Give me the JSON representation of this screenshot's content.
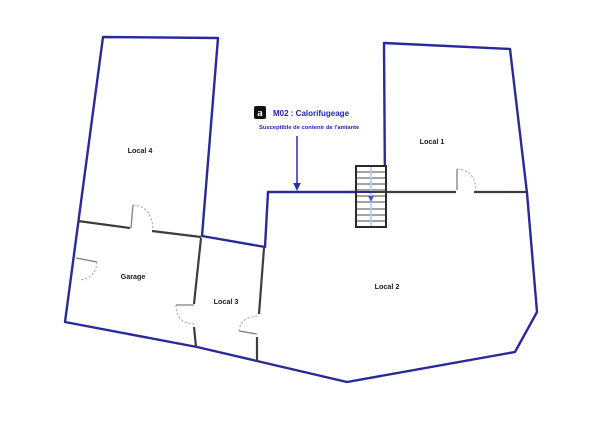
{
  "plan": {
    "rooms": [
      {
        "id": "local-4",
        "label": "Local 4"
      },
      {
        "id": "local-1",
        "label": "Local 1"
      },
      {
        "id": "garage",
        "label": "Garage"
      },
      {
        "id": "local-3",
        "label": "Local 3"
      },
      {
        "id": "local-2",
        "label": "Local 2"
      }
    ],
    "annotation": {
      "icon_glyph": "a",
      "title": "M02 : Calorifugeage",
      "subtitle": "Susceptible de contenir de l'amiante"
    },
    "colors": {
      "exterior_wall": "#29299a",
      "interior_wall": "#3d3d3d",
      "annotation_blue": "#2323b4",
      "arrow_blue": "#2a2ac0",
      "stair_border": "#2a2a2a",
      "stair_centerline": "#b7c9ee",
      "stair_arrow": "#3c5cc4",
      "label_text": "#1c1c1c"
    }
  }
}
